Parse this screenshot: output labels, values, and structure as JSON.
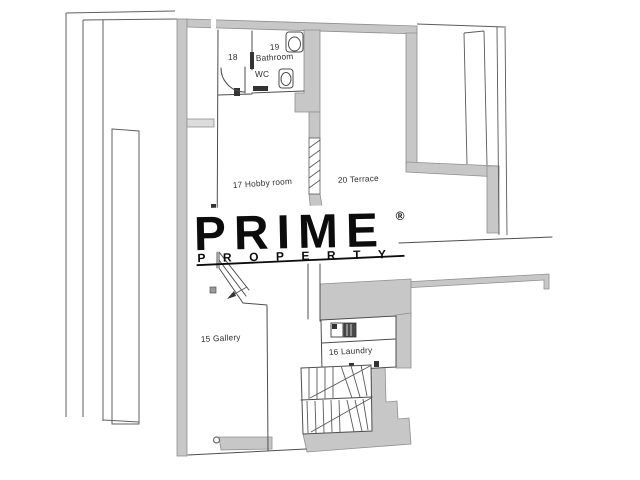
{
  "watermark": {
    "brand": "PRIME",
    "registered_mark": "®",
    "subtitle": "PROPERTY"
  },
  "rooms": {
    "room18": {
      "number": "18"
    },
    "bathroom": {
      "number": "19",
      "name": "Bathroom",
      "fixture_label": "WC"
    },
    "hobby": {
      "label": "17 Hobby room"
    },
    "terrace": {
      "label": "20 Terrace"
    },
    "gallery": {
      "label": "15 Gallery"
    },
    "laundry": {
      "label": "16 Laundry"
    }
  },
  "colors": {
    "background": "#ffffff",
    "wall_fill": "#c7c7c7",
    "wall_edge": "#8f8f8f",
    "line": "#4d4d4d",
    "label_text": "#2e2e2e",
    "logo": "#0c0c0c"
  }
}
